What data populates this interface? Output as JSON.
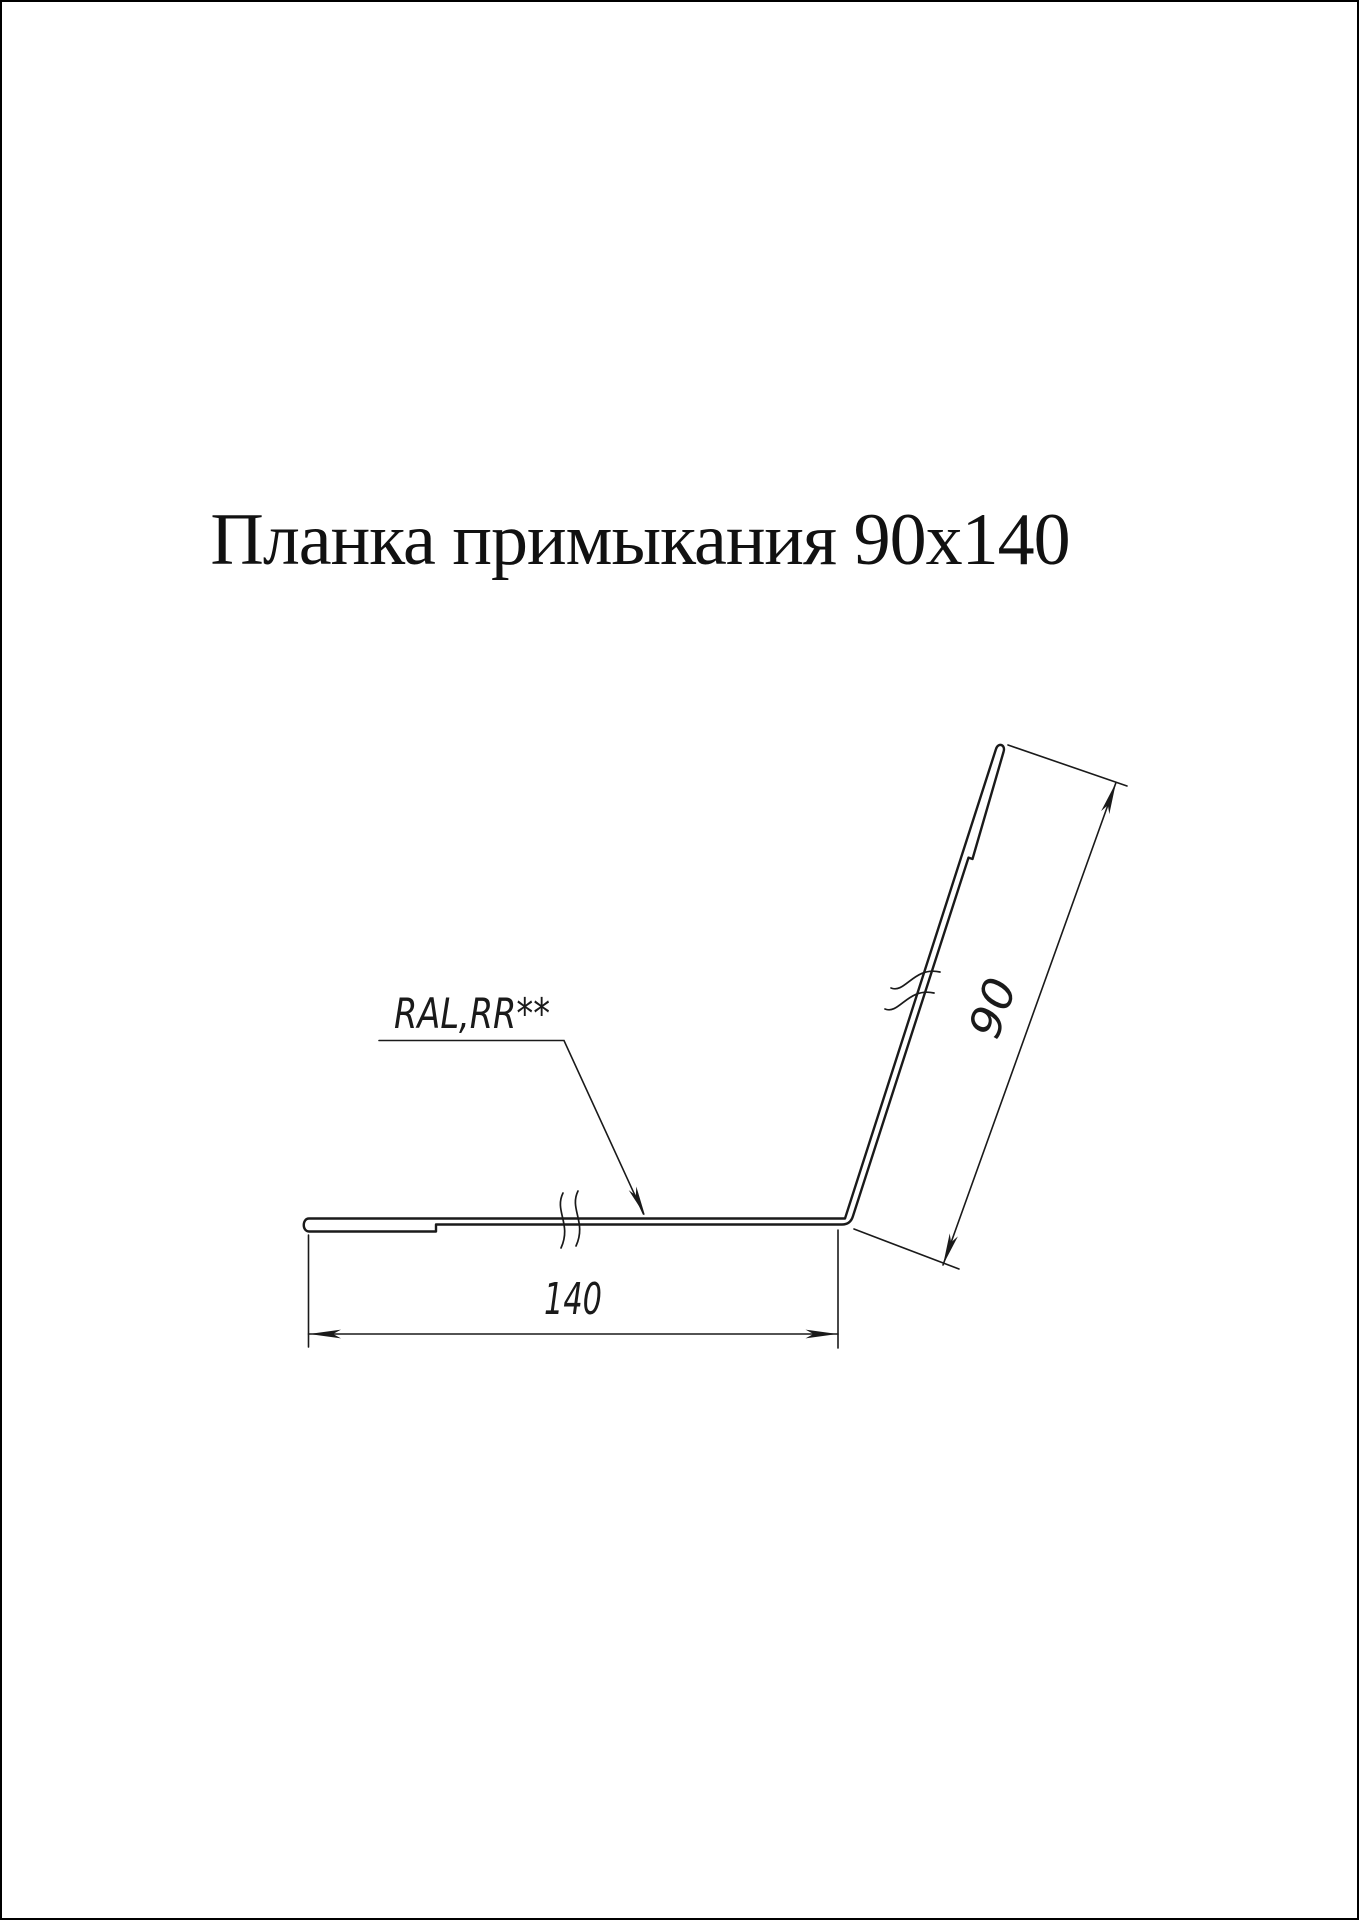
{
  "page": {
    "background_color": "#ffffff",
    "frame_color": "#000000",
    "line_color": "#1a1a1a"
  },
  "title": {
    "text": "Планка примыкания 90х140"
  },
  "drawing": {
    "material_label": "RAL,RR**",
    "dim_width": "140",
    "dim_height": "90"
  }
}
